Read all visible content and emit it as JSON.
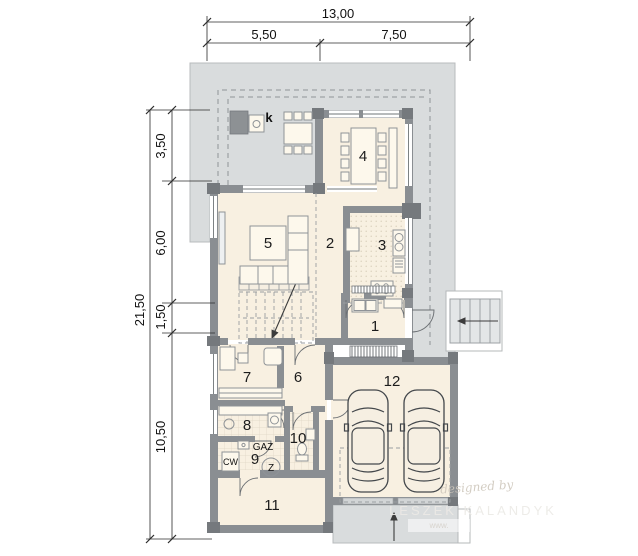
{
  "dims": {
    "w_total": "13,00",
    "w_a": "5,50",
    "w_b": "7,50",
    "h_total": "21,50",
    "h_a": "3,50",
    "h_b": "6,00",
    "h_c": "1,50",
    "h_d": "10,50"
  },
  "rooms": {
    "n1": "1",
    "n2": "2",
    "n3": "3",
    "n4": "4",
    "n5": "5",
    "n6": "6",
    "n7": "7",
    "n8": "8",
    "n9": "9",
    "n10": "10",
    "n11": "11",
    "n12": "12"
  },
  "labels": {
    "k": "k",
    "gaz": "GAZ",
    "cw": "CW",
    "z": "Z"
  },
  "watermark": {
    "credit": "designed by",
    "author": "LESZEK KALANDYK",
    "url": "www."
  },
  "colors": {
    "terrace": "#d9dcdd",
    "wall": "#8a8e92",
    "wall_dark": "#75797d",
    "floor": "#f8f0e1",
    "outline_dark": "#43474b"
  }
}
